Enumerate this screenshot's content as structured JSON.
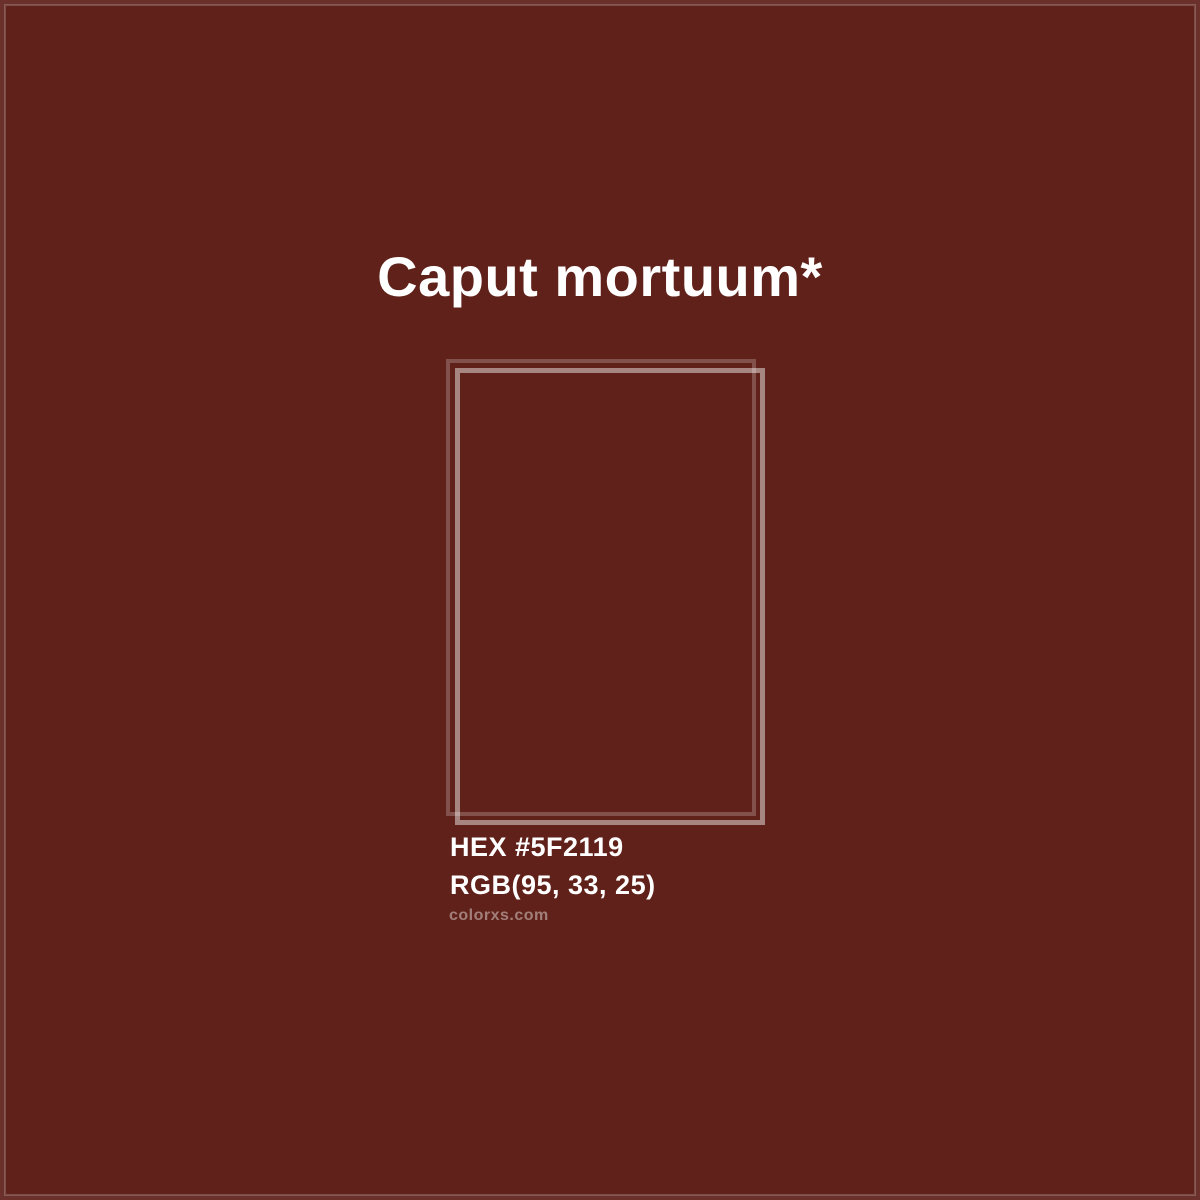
{
  "page": {
    "title": "Caput mortuum*",
    "hex_label": "HEX #5F2119",
    "rgb_label": "RGB(95, 33, 25)",
    "watermark": "colorxs.com",
    "colors": {
      "background": "#5F2119",
      "rgb_value": "95, 33, 25",
      "title_text": "#FFFFFF",
      "watermark_text": "rgba(255,255,255,0.42)",
      "frame_back_border": "rgba(255,255,255,0.22)",
      "frame_front_border": "rgba(255,255,255,0.45)"
    }
  }
}
